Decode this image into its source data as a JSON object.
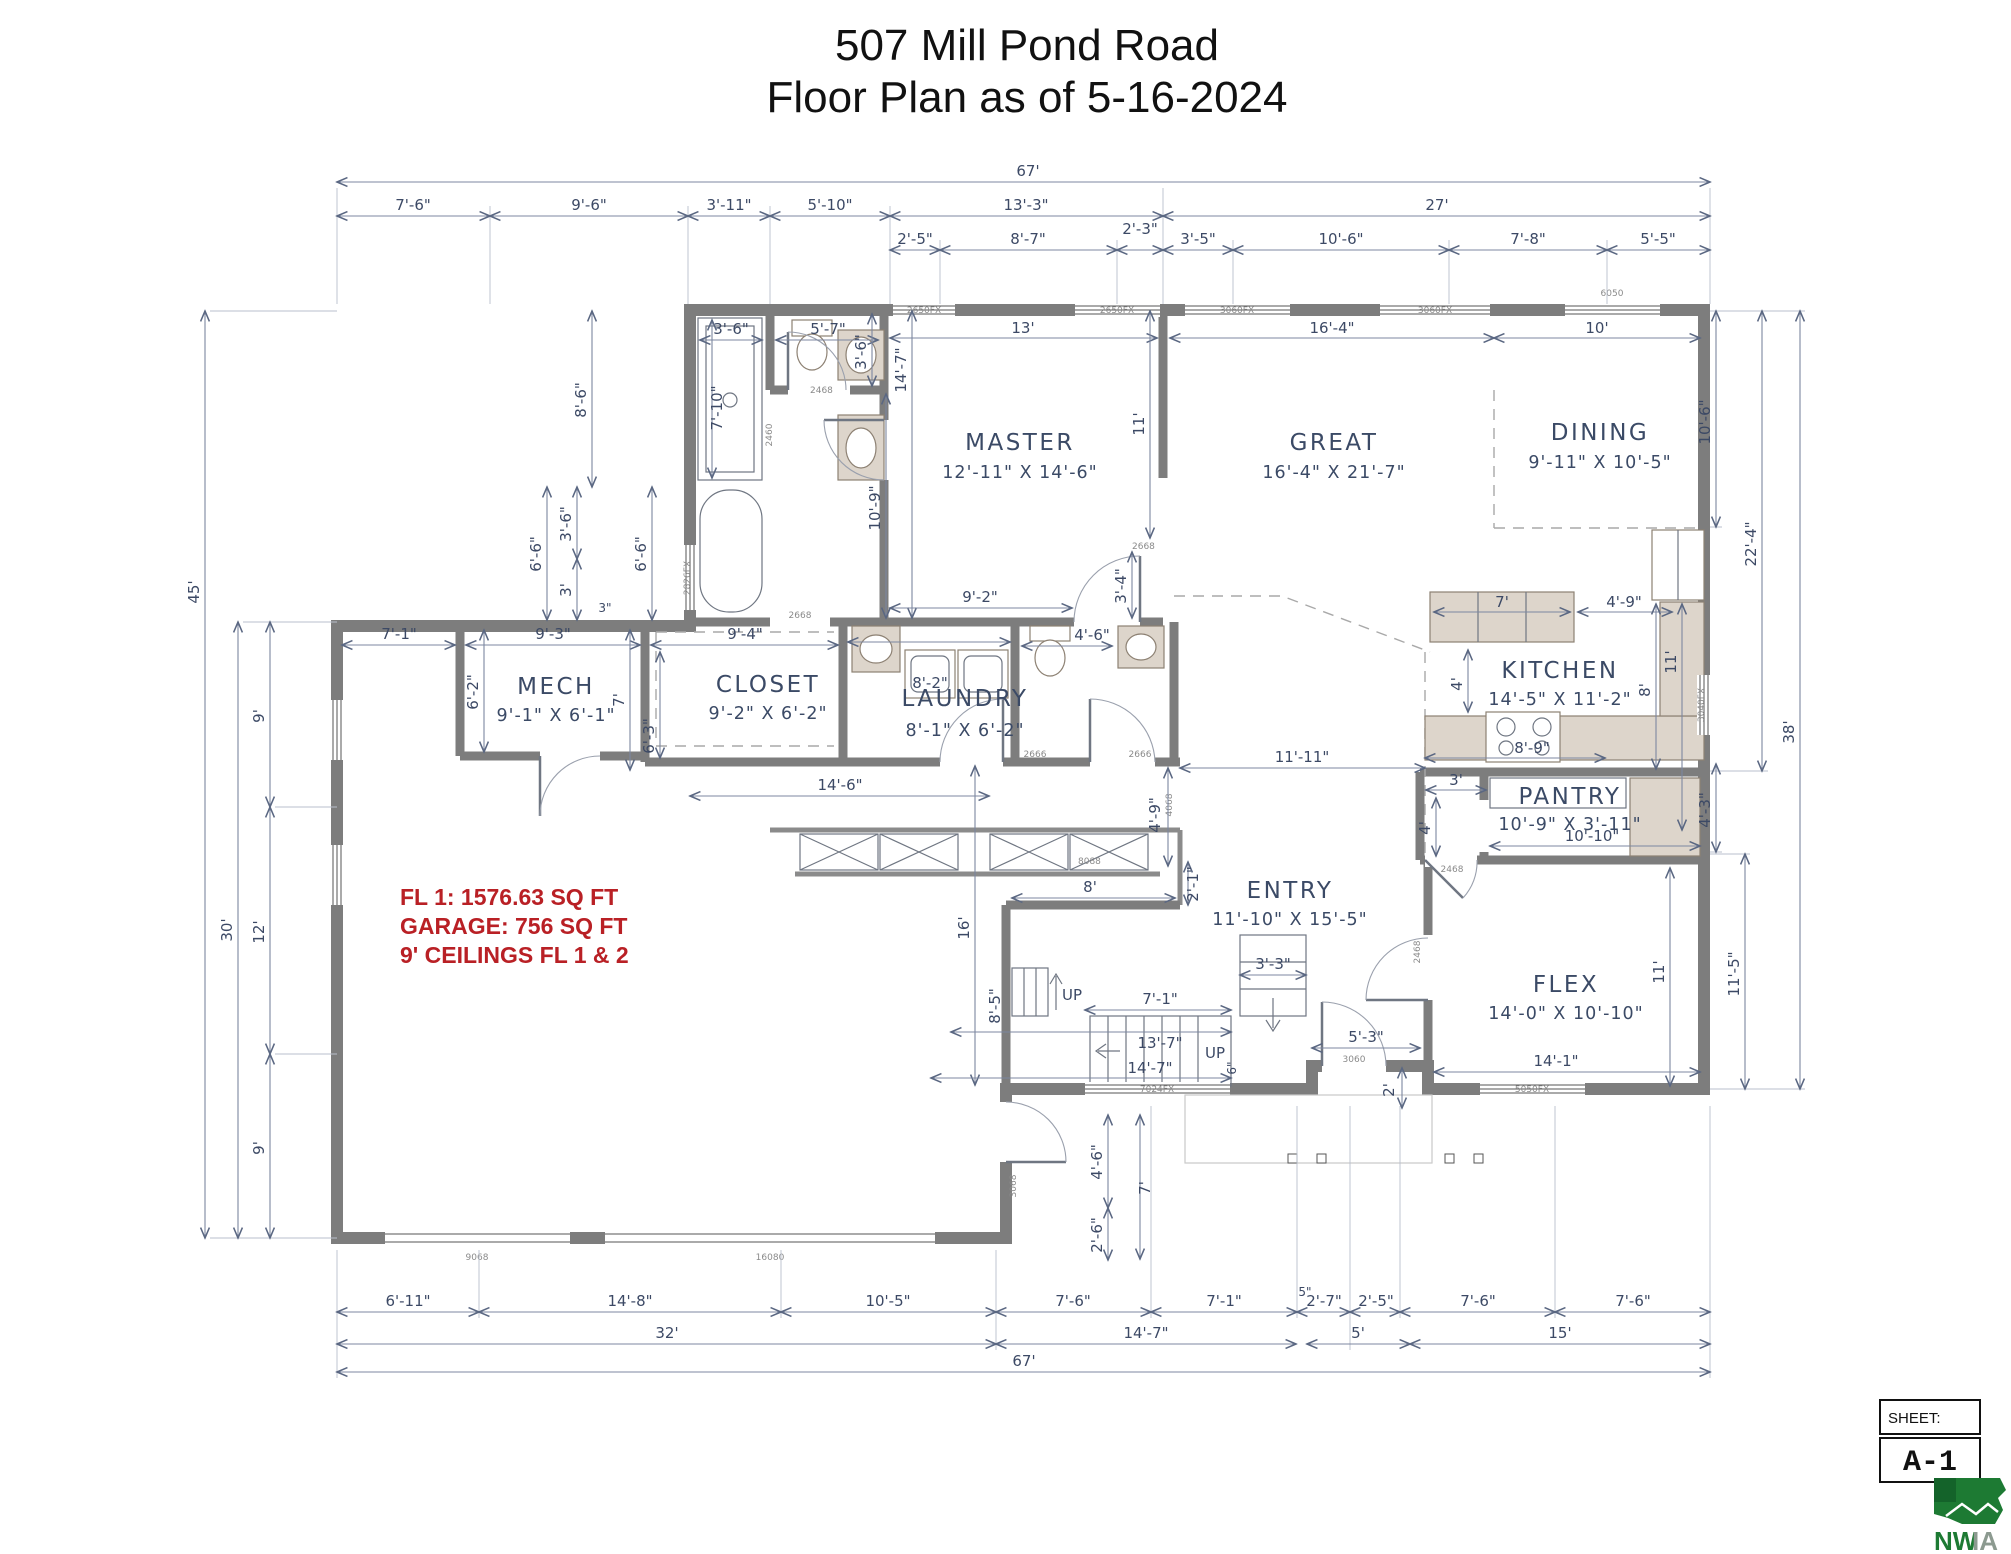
{
  "title": {
    "line1": "507 Mill Pond Road",
    "line2": "Floor Plan as of 5-16-2024"
  },
  "annotation": {
    "line1": "FL 1: 1576.63 SQ FT",
    "line2": "GARAGE: 756 SQ FT",
    "line3": "9' CEILINGS FL 1 & 2",
    "color": "#b92025"
  },
  "rooms": [
    {
      "name": "MASTER",
      "dims": "12'-11\" X 14'-6\""
    },
    {
      "name": "GREAT",
      "dims": "16'-4\" X 21'-7\""
    },
    {
      "name": "DINING",
      "dims": "9'-11\" X 10'-5\""
    },
    {
      "name": "KITCHEN",
      "dims": "14'-5\" X 11'-2\""
    },
    {
      "name": "PANTRY",
      "dims": "10'-9\" X 3'-11\""
    },
    {
      "name": "ENTRY",
      "dims": "11'-10\" X 15'-5\""
    },
    {
      "name": "FLEX",
      "dims": "14'-0\" X 10'-10\""
    },
    {
      "name": "LAUNDRY",
      "dims": "8'-1\" X 6'-2\""
    },
    {
      "name": "CLOSET",
      "dims": "9'-2\" X 6'-2\""
    },
    {
      "name": "MECH",
      "dims": "9'-1\" X 6'-1\""
    }
  ],
  "stairs": {
    "up": "UP"
  },
  "d": {
    "t67": "67'",
    "t1a": "7'-6\"",
    "t1b": "9'-6\"",
    "t1c": "3'-11\"",
    "t1d": "5'-10\"",
    "t1e": "13'-3\"",
    "t1f": "27'",
    "t2a": "2'-5\"",
    "t2b": "8'-7\"",
    "t2c": "2'-3\"",
    "t2d": "3'-5\"",
    "t2e": "10'-6\"",
    "t2f": "7'-8\"",
    "t2g": "5'-5\"",
    "i13": "13'",
    "i164": "16'-4\"",
    "i10": "10'",
    "l45": "45'",
    "l30": "30'",
    "l9a": "9'",
    "l12": "12'",
    "l9b": "9'",
    "r106": "10'-6\"",
    "r224": "22'-4\"",
    "r38": "38'",
    "r43": "4'-3\"",
    "r115": "11'-5\"",
    "b1a": "6'-11\"",
    "b1b": "14'-8\"",
    "b1c": "10'-5\"",
    "b1d": "7'-6\"",
    "b1e": "7'-1\"",
    "b5": "5\"",
    "b1f": "2'-7\"",
    "b1g": "2'-5\"",
    "b1h": "7'-6\"",
    "b1i": "7'-6\"",
    "b2a": "32'",
    "b2b": "14'-7\"",
    "b2c": "5'",
    "b2d": "15'",
    "b3": "67'",
    "m86": "8'-6\"",
    "m36sh": "3'-6\"",
    "m57": "5'-7\"",
    "m36wc": "3'-6\"",
    "m710": "7'-10\"",
    "m109": "10'-9\"",
    "m147": "14'-7\"",
    "m66a": "6'-6\"",
    "m36c": "3'-6\"",
    "m3": "3'",
    "m3i": "3\"",
    "m66b": "6'-6\"",
    "m92": "9'-2\"",
    "m34": "3'-4\"",
    "m11g": "11'",
    "m71": "7'-1\"",
    "m93": "9'-3\"",
    "m62": "6'-2\"",
    "m7m": "7'",
    "m94": "9'-4\"",
    "m63": "6'-3\"",
    "m82": "8'-2\"",
    "m46b": "4'-6\"",
    "m146": "14'-6\"",
    "m1111": "11'-11\"",
    "m49h": "4'-9\"",
    "m16": "16'",
    "m85": "8'-5\"",
    "m8c": "8'",
    "m21": "2'-1\"",
    "s71": "7'-1\"",
    "s137": "13'-7\"",
    "s147": "14'-7\"",
    "s33": "3'-3\"",
    "s6": "6\"",
    "e53": "5'-3\"",
    "e2": "2'",
    "p46": "4'-6\"",
    "p26": "2'-6\"",
    "p7": "7'",
    "k7": "7'",
    "k4": "4'",
    "k49": "4'-9\"",
    "k89": "8'-9\"",
    "k11": "11'",
    "k8": "8'",
    "pa3": "3'",
    "pa4": "4'",
    "pa1010": "10'-10\"",
    "f141": "14'-1\"",
    "f11": "11'"
  },
  "labels": {
    "w2650": "2650FX",
    "w3060": "3060FX",
    "w6050": "6050",
    "w3040": "3040FX",
    "w5050": "5050FX",
    "w7024": "7024FX",
    "w2826": "2826FX",
    "d2468": "2468",
    "d2460": "2460",
    "d2668": "2668",
    "d2666": "2666",
    "d8088": "8088",
    "d3060": "3060",
    "d3068": "3068",
    "d4068": "4068",
    "d9068": "9068",
    "d16080": "16080"
  },
  "sheet": {
    "label": "SHEET:",
    "number": "A-1"
  },
  "logo": {
    "text_nw": "NW",
    "text_ia": "IA"
  }
}
